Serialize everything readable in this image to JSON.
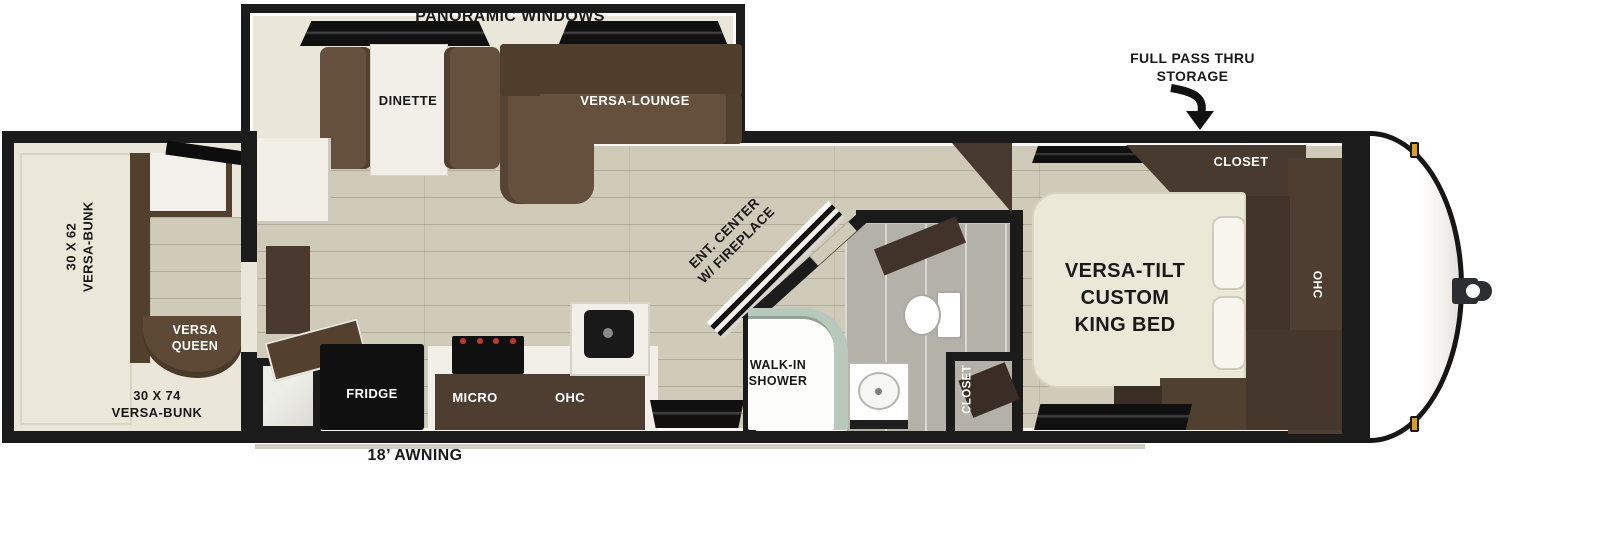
{
  "labels": {
    "panoramic_windows": "PANORAMIC WINDOWS",
    "full_pass_thru_line1": "FULL PASS THRU",
    "full_pass_thru_line2": "STORAGE",
    "dinette": "DINETTE",
    "versa_lounge": "VERSA-LOUNGE",
    "side_bunk_line1": "30 X 62",
    "side_bunk_line2": "VERSA-BUNK",
    "versa_queen_line1": "VERSA",
    "versa_queen_line2": "QUEEN",
    "rear_bunk_line1": "30 X 74",
    "rear_bunk_line2": "VERSA-BUNK",
    "ent_center_line1": "ENT. CENTER",
    "ent_center_line2": "W/ FIREPLACE",
    "fridge": "FRIDGE",
    "micro": "MICRO",
    "kitchen_ohc": "OHC",
    "walk_in_shower_line1": "WALK-IN",
    "walk_in_shower_line2": "SHOWER",
    "bath_closet": "CLOSET",
    "bedroom_closet": "CLOSET",
    "king_bed_line1": "VERSA-TILT",
    "king_bed_line2": "CUSTOM",
    "king_bed_line3": "KING BED",
    "bedroom_ohc": "OHC",
    "awning": "18’ AWNING"
  },
  "colors": {
    "wall": "#1b1b1b",
    "floor_wood": "#cfcbb8",
    "floor_cream": "#eae7da",
    "sofa_brown": "#64503c",
    "sofa_brown_dark": "#503e2d",
    "cabinet_brown": "#4e3d31",
    "dark_cabinet": "#41332a",
    "appliance_black": "#101010",
    "counter_white": "#f1efe8",
    "shower_sage": "#b8c9bb",
    "bath_gray": "#b4b1a9",
    "marker_gold": "#d99f25"
  }
}
